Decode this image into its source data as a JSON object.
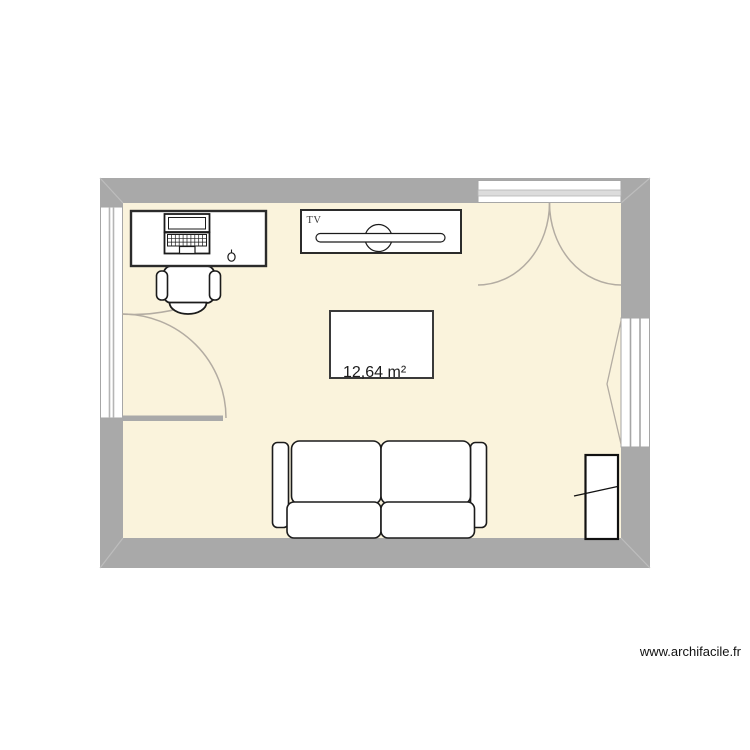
{
  "app": {
    "watermark": "www.archifacile.fr"
  },
  "plan": {
    "room": {
      "area_label": "12,64 m²",
      "floor_color": "#FAF3DC",
      "wall_color": "#A9A9A9",
      "outline_color": "#1B1B1B",
      "door_swing_color": "#B3ACA2"
    },
    "labels": {
      "tv": "TV"
    },
    "objects": [
      {
        "name": "desk-with-laptop-and-mouse"
      },
      {
        "name": "office-chair"
      },
      {
        "name": "tv-cabinet"
      },
      {
        "name": "coffee-table"
      },
      {
        "name": "two-seat-sofa"
      },
      {
        "name": "radiator"
      },
      {
        "name": "single-door-left"
      },
      {
        "name": "french-double-door-top"
      },
      {
        "name": "window-left"
      },
      {
        "name": "window-right"
      }
    ]
  }
}
